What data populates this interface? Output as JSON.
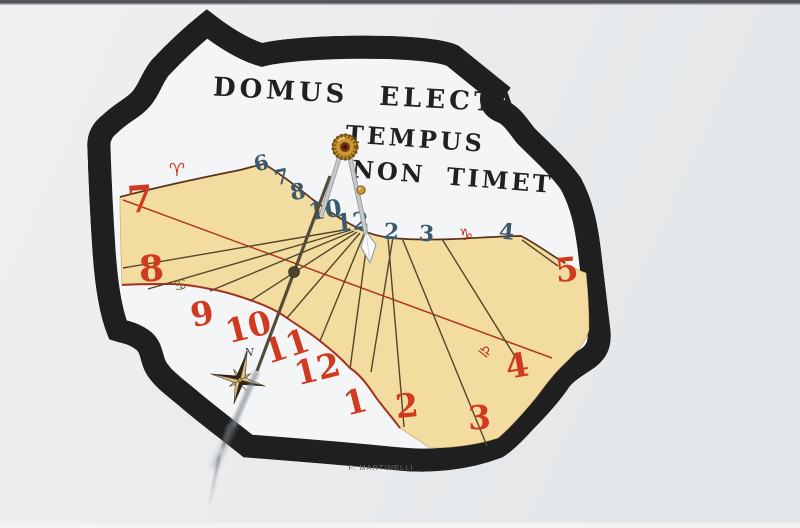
{
  "scene": {
    "description": "Photograph of a painted vertical sundial on a white wall",
    "year_text": "A.D. 2004",
    "signature": "F. MARTINELLI",
    "compass_label": "N"
  },
  "motto": {
    "line1": "DOMUS ELECTA",
    "line2": "TEMPUS",
    "line3": "NON TIMET"
  },
  "colors": {
    "wall": "#eaecee",
    "band": "#a7abad",
    "band_edge": "#1f1f1f",
    "face": "#f3f5f6",
    "beige": "#f2dca0",
    "winter_curve": "#5e3018",
    "summer_curve": "#a5301a",
    "equinox": "#b5361c",
    "hour_line": "#55452a",
    "blue_numeral": "#3a5a70",
    "red_numeral": "#d03b20",
    "gold": "#c79a33",
    "rod_gray": "#c6c9cb",
    "rod_olive": "#554b3a",
    "shadow": "#5f6870",
    "star_dark": "#2e2418",
    "star_light": "#d9ba85"
  },
  "hour_lines": [
    {
      "x1": 350,
      "y1": 229,
      "x2": 123,
      "y2": 268
    },
    {
      "x1": 351,
      "y1": 230,
      "x2": 148,
      "y2": 289
    },
    {
      "x1": 354,
      "y1": 231,
      "x2": 210,
      "y2": 291
    },
    {
      "x1": 357,
      "y1": 232,
      "x2": 250,
      "y2": 301
    },
    {
      "x1": 360,
      "y1": 233,
      "x2": 287,
      "y2": 318
    },
    {
      "x1": 364,
      "y1": 234,
      "x2": 320,
      "y2": 341
    },
    {
      "x1": 368,
      "y1": 235,
      "x2": 350,
      "y2": 369
    },
    {
      "x1": 393,
      "y1": 237,
      "x2": 371,
      "y2": 372
    },
    {
      "x1": 388,
      "y1": 238,
      "x2": 404,
      "y2": 427
    },
    {
      "x1": 402,
      "y1": 238,
      "x2": 487,
      "y2": 446
    },
    {
      "x1": 442,
      "y1": 239,
      "x2": 516,
      "y2": 358
    },
    {
      "x1": 522,
      "y1": 240,
      "x2": 558,
      "y2": 266
    }
  ],
  "blue_numerals": [
    {
      "label": "6",
      "x": 263,
      "y": 170,
      "rot": -14,
      "size": 21
    },
    {
      "label": "7",
      "x": 283,
      "y": 184,
      "rot": -12,
      "size": 21
    },
    {
      "label": "8",
      "x": 299,
      "y": 199,
      "rot": -10,
      "size": 22
    },
    {
      "label": "10",
      "x": 326,
      "y": 218,
      "rot": -8,
      "size": 24
    },
    {
      "label": "12",
      "x": 353,
      "y": 230,
      "rot": -5,
      "size": 24
    },
    {
      "label": "2",
      "x": 391,
      "y": 239,
      "rot": 3,
      "size": 22
    },
    {
      "label": "3",
      "x": 426,
      "y": 241,
      "rot": 4,
      "size": 22
    },
    {
      "label": "4",
      "x": 506,
      "y": 239,
      "rot": 5,
      "size": 22
    }
  ],
  "red_numerals": [
    {
      "label": "7",
      "x": 141,
      "y": 212,
      "rot": -4,
      "size": 37
    },
    {
      "label": "8",
      "x": 152,
      "y": 281,
      "rot": -3,
      "size": 36
    },
    {
      "label": "9",
      "x": 204,
      "y": 325,
      "rot": -10,
      "size": 33
    },
    {
      "label": "10",
      "x": 251,
      "y": 338,
      "rot": -14,
      "size": 33
    },
    {
      "label": "11",
      "x": 290,
      "y": 357,
      "rot": -18,
      "size": 33
    },
    {
      "label": "12",
      "x": 320,
      "y": 380,
      "rot": -14,
      "size": 33
    },
    {
      "label": "1",
      "x": 358,
      "y": 413,
      "rot": -14,
      "size": 33
    },
    {
      "label": "2",
      "x": 408,
      "y": 417,
      "rot": -6,
      "size": 33
    },
    {
      "label": "3",
      "x": 480,
      "y": 429,
      "rot": -3,
      "size": 33
    },
    {
      "label": "4",
      "x": 519,
      "y": 377,
      "rot": -10,
      "size": 33
    },
    {
      "label": "5",
      "x": 568,
      "y": 281,
      "rot": -6,
      "size": 33
    }
  ],
  "zodiac_symbols": [
    {
      "name": "aries",
      "sym": "♈",
      "x": 177,
      "y": 176,
      "rot": 0,
      "color": "#c23c1c",
      "size": 18
    },
    {
      "name": "cancer",
      "sym": "♋",
      "x": 181,
      "y": 290,
      "rot": -8,
      "color": "#6d5a26",
      "size": 15
    },
    {
      "name": "libra",
      "sym": "♎",
      "x": 482,
      "y": 355,
      "rot": 38,
      "color": "#b5361c",
      "size": 15
    },
    {
      "name": "capricorn",
      "sym": "♑",
      "x": 466,
      "y": 240,
      "rot": 0,
      "color": "#b5361c",
      "size": 16
    }
  ]
}
